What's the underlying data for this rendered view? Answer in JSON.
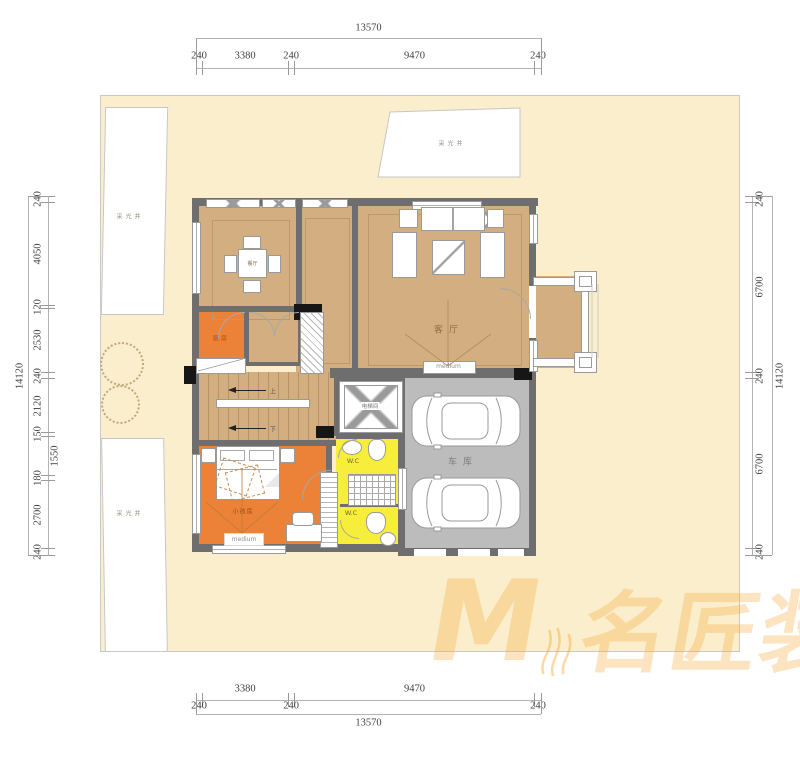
{
  "dimensions": {
    "top": {
      "total": "13570",
      "segments": [
        "240",
        "3380",
        "240",
        "9470",
        "240"
      ]
    },
    "bottom": {
      "total": "13570",
      "segments": [
        "240",
        "3380",
        "240",
        "9470",
        "240"
      ]
    },
    "left": {
      "total": "14120",
      "segments": [
        "240",
        "4050",
        "120",
        "2530",
        "240",
        "2120",
        "150",
        "1550",
        "180",
        "2700",
        "240"
      ]
    },
    "right": {
      "total": "14120",
      "segments": [
        "240",
        "6700",
        "240",
        "6700",
        "240"
      ]
    }
  },
  "rooms": {
    "dining": "餐厅",
    "living": "客厅",
    "garage": "车库",
    "elevator": "电梯间",
    "kitchen": "厨房",
    "bedroom": "小孩房",
    "wc_upper": "W.C",
    "wc_lower": "W.C",
    "stairs_up": "上",
    "stairs_down": "下"
  },
  "site": {
    "lightwell_top": "采光井",
    "lightwell_left_upper": "采光井",
    "lightwell_left_lower": "采光井"
  },
  "stamps": {
    "living": "medium",
    "bedroom": "medium"
  },
  "watermark": {
    "m": "M",
    "text": "名匠装饰"
  },
  "colors": {
    "cream": "#fbeecd",
    "tan": "#d2ae80",
    "wall": "#6e6e6e",
    "garage_gray": "#bcbcbc",
    "orange": "#eb8237",
    "yellow": "#f7ee3c",
    "watermark_orange": "#f5aa3c"
  }
}
